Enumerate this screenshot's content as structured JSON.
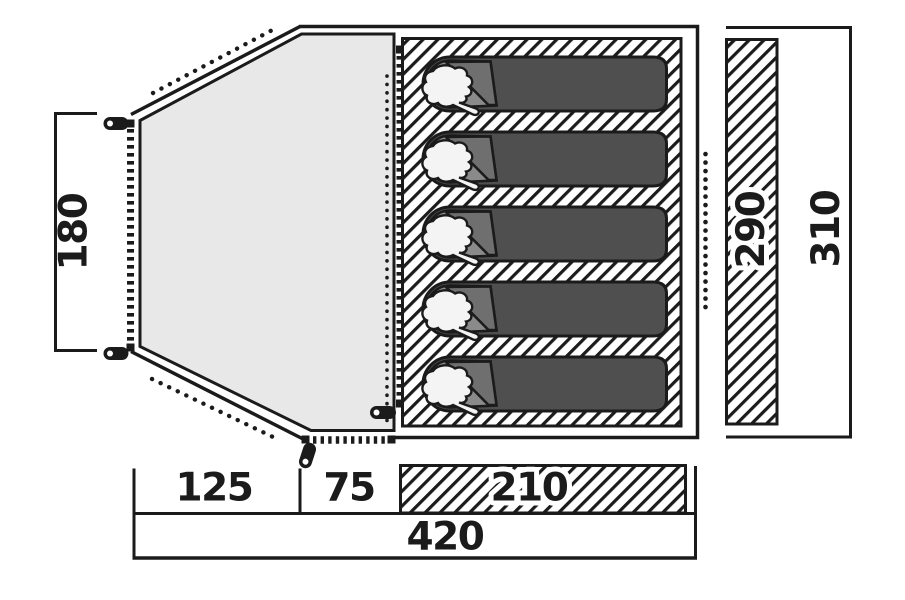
{
  "diagram": {
    "title": "tent floor plan top view",
    "sleeping_bag_count": 5,
    "colors": {
      "line": "#1b1b1b",
      "porch": "#e8e8e8",
      "bag_body": "#4f4f4f",
      "bag_head": "#8a8a8a",
      "bag_flap": "#6f6f6f",
      "pillow": "#f4f4f4",
      "background": "#ffffff"
    },
    "dimensions": {
      "front_width": {
        "label": "180"
      },
      "segments": [
        {
          "label": "125"
        },
        {
          "label": "75"
        },
        {
          "label": "210"
        }
      ],
      "total_width": {
        "label": "420"
      },
      "inner_depth": {
        "label": "290"
      },
      "total_depth": {
        "label": "310"
      }
    }
  }
}
